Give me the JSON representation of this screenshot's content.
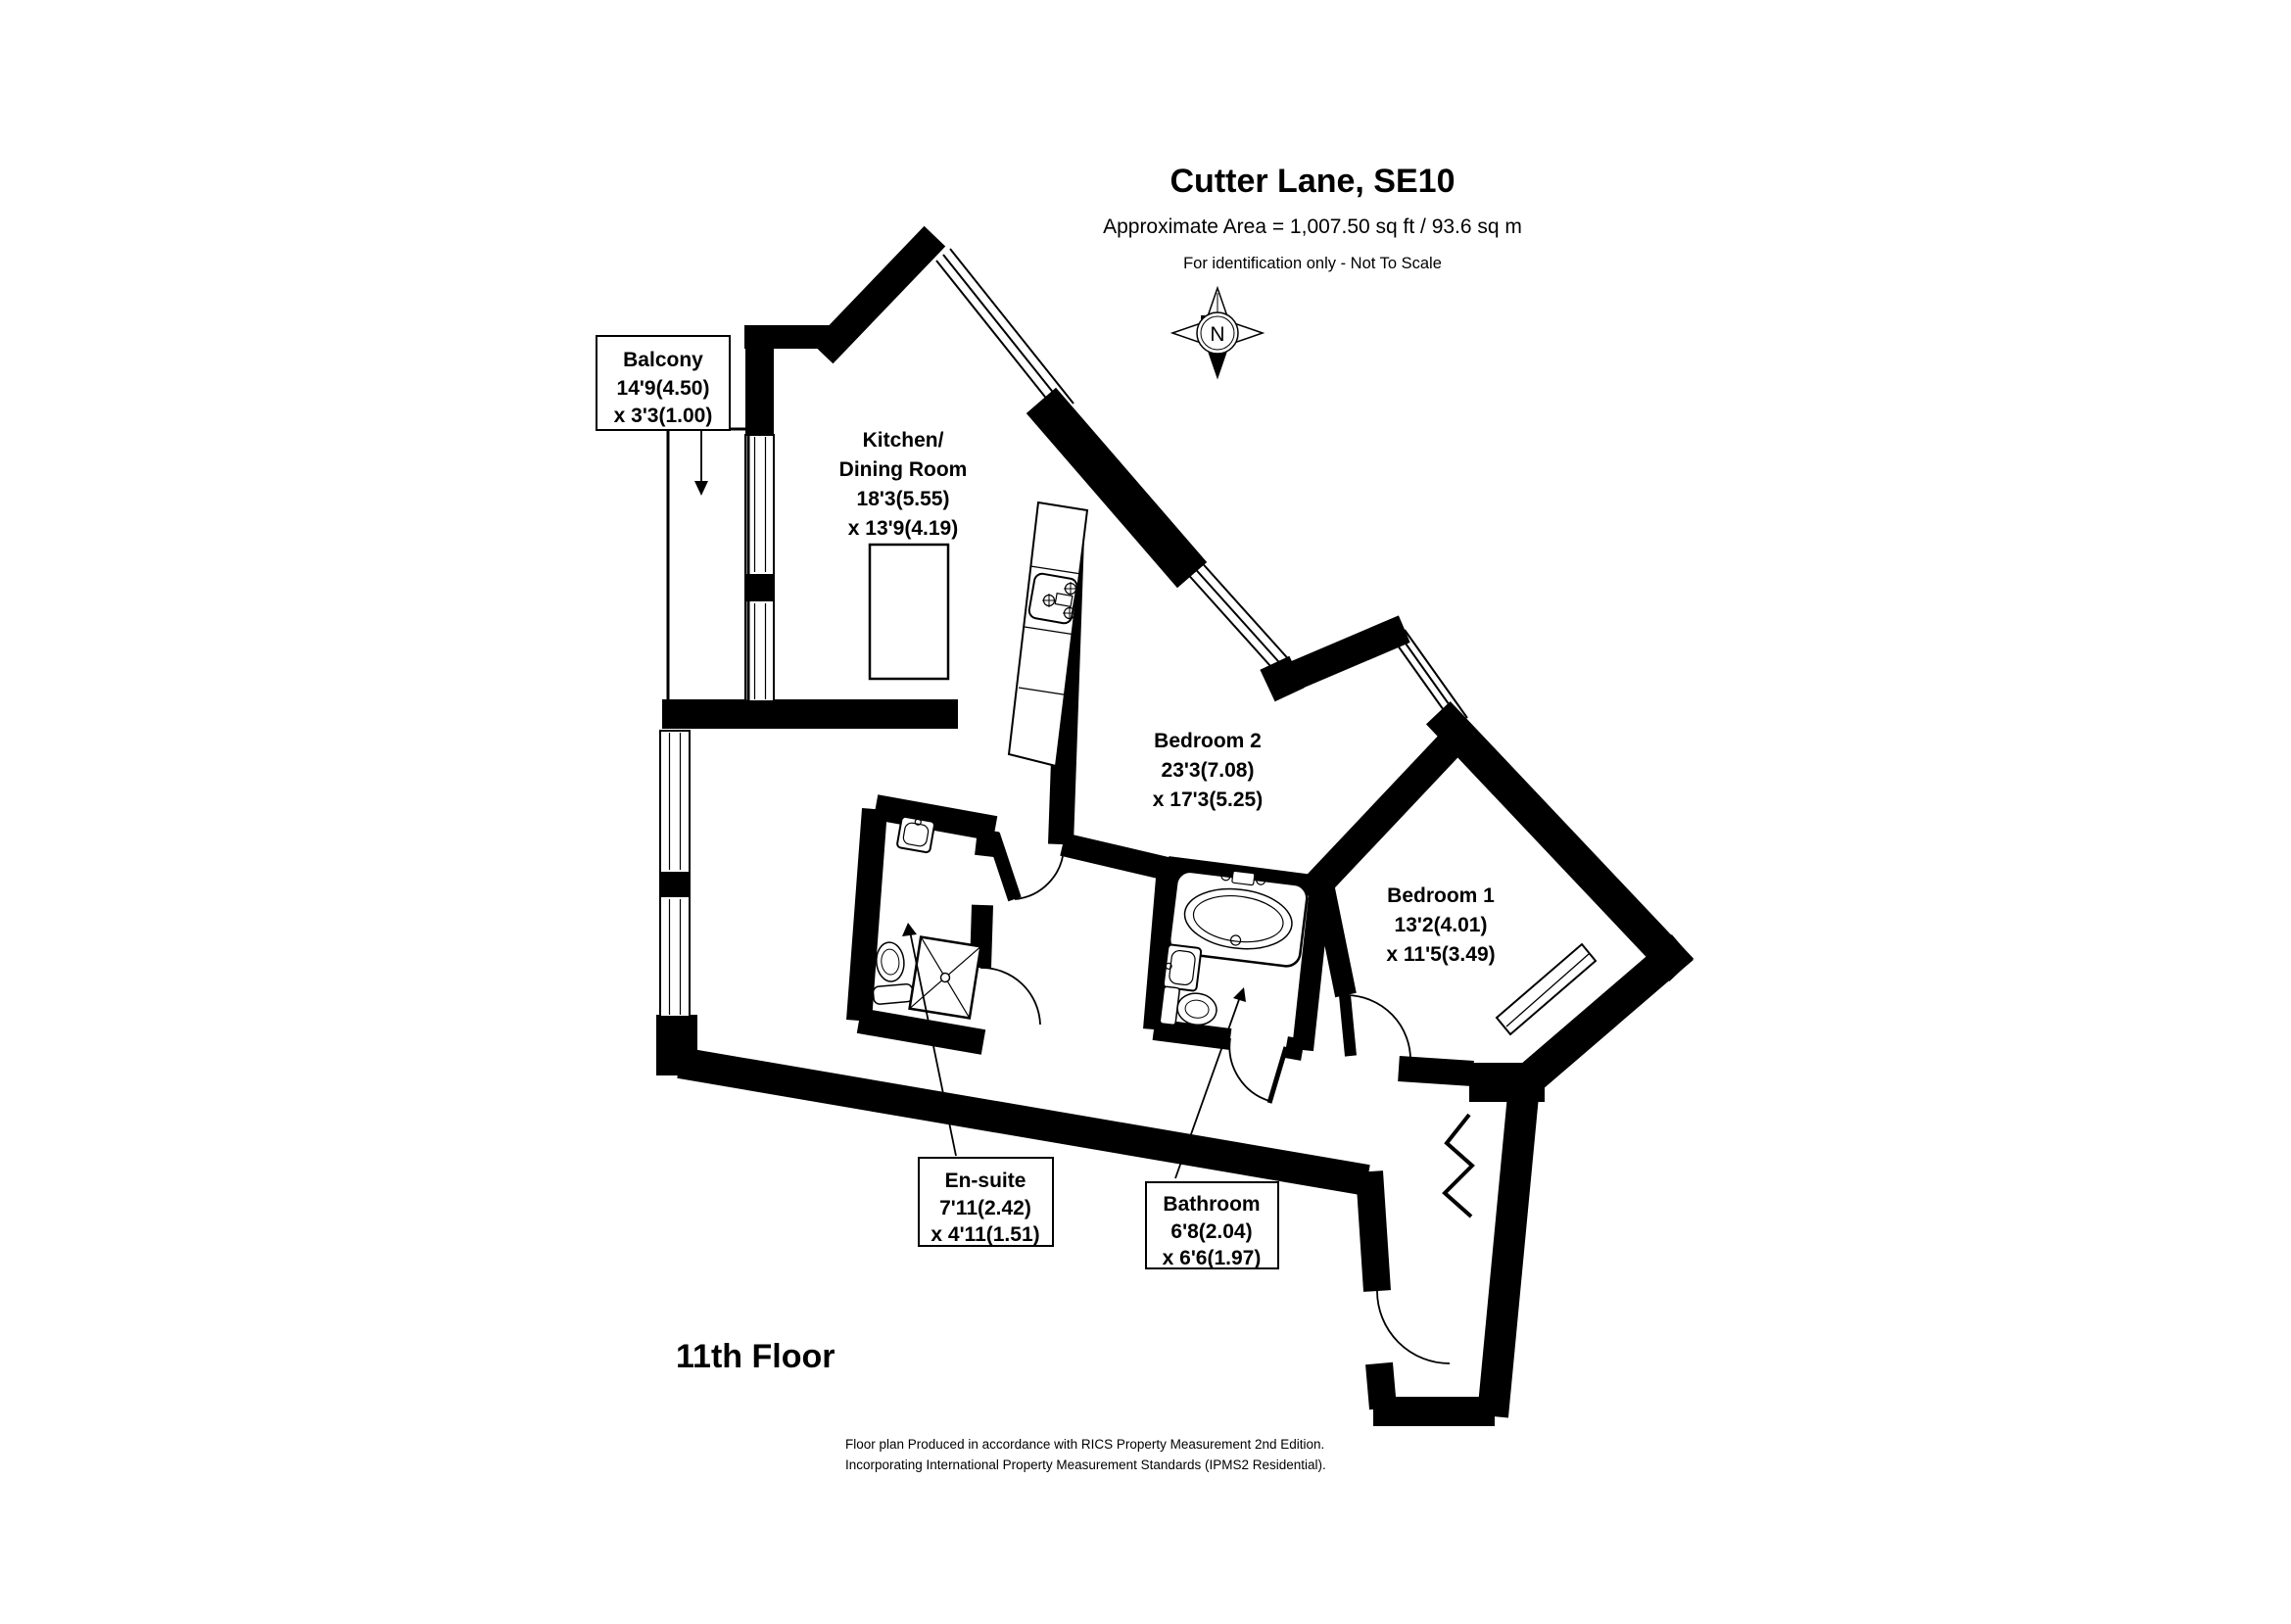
{
  "header": {
    "title": "Cutter Lane, SE10",
    "area": "Approximate Area = 1,007.50 sq ft / 93.6 sq m",
    "disclaimer": "For identification only - Not To Scale"
  },
  "compass": {
    "label": "N"
  },
  "rooms": {
    "balcony": {
      "name": "Balcony",
      "dim1": "14'9(4.50)",
      "dim2": "x 3'3(1.00)"
    },
    "kitchen": {
      "name1": "Kitchen/",
      "name2": "Dining Room",
      "dim1": "18'3(5.55)",
      "dim2": "x 13'9(4.19)"
    },
    "bedroom2": {
      "name": "Bedroom 2",
      "dim1": "23'3(7.08)",
      "dim2": "x 17'3(5.25)"
    },
    "bedroom1": {
      "name": "Bedroom 1",
      "dim1": "13'2(4.01)",
      "dim2": "x 11'5(3.49)"
    },
    "ensuite": {
      "name": "En-suite",
      "dim1": "7'11(2.42)",
      "dim2": "x 4'11(1.51)"
    },
    "bathroom": {
      "name": "Bathroom",
      "dim1": "6'8(2.04)",
      "dim2": "x 6'6(1.97)"
    }
  },
  "floor_label": "11th Floor",
  "footer": {
    "line1": "Floor plan Produced in accordance with RICS Property Measurement 2nd Edition.",
    "line2": "Incorporating International Property Measurement Standards (IPMS2  Residential)."
  },
  "colors": {
    "wall": "#000000",
    "background": "#ffffff"
  }
}
